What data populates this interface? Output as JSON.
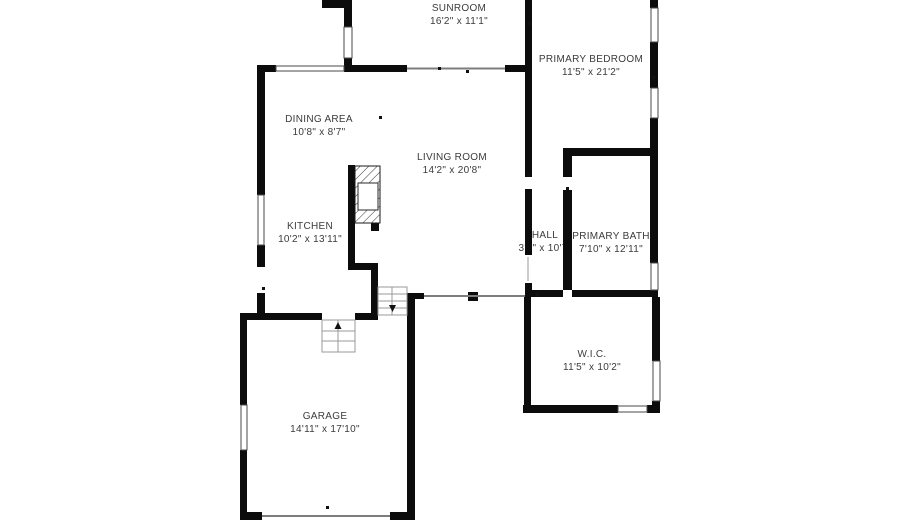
{
  "title": "Floor plan",
  "colors": {
    "wall": "#0c0c0c",
    "window_frame": "#4a4a4a",
    "opening_line": "#7d7d7d",
    "stair_line": "#9a9a9a",
    "text": "#3b3b3b",
    "background": "#ffffff"
  },
  "plan": {
    "rooms": [
      {
        "id": "sunroom",
        "name": "SUNROOM",
        "dims": "16'2\" x 11'1\""
      },
      {
        "id": "primary-bedroom",
        "name": "PRIMARY BEDROOM",
        "dims": "11'5\" x 21'2\""
      },
      {
        "id": "dining-area",
        "name": "DINING AREA",
        "dims": "10'8\" x 8'7\""
      },
      {
        "id": "living-room",
        "name": "LIVING ROOM",
        "dims": "14'2\" x 20'8\""
      },
      {
        "id": "kitchen",
        "name": "KITCHEN",
        "dims": "10'2\" x 13'11\""
      },
      {
        "id": "hall",
        "name": "HALL",
        "dims": "3'3\" x 10'7\""
      },
      {
        "id": "primary-bath",
        "name": "PRIMARY BATH",
        "dims": "7'10\" x 12'11\""
      },
      {
        "id": "wic",
        "name": "W.I.C.",
        "dims": "11'5\" x 10'2\""
      },
      {
        "id": "garage",
        "name": "GARAGE",
        "dims": "14'11\" x 17'10\""
      }
    ]
  }
}
